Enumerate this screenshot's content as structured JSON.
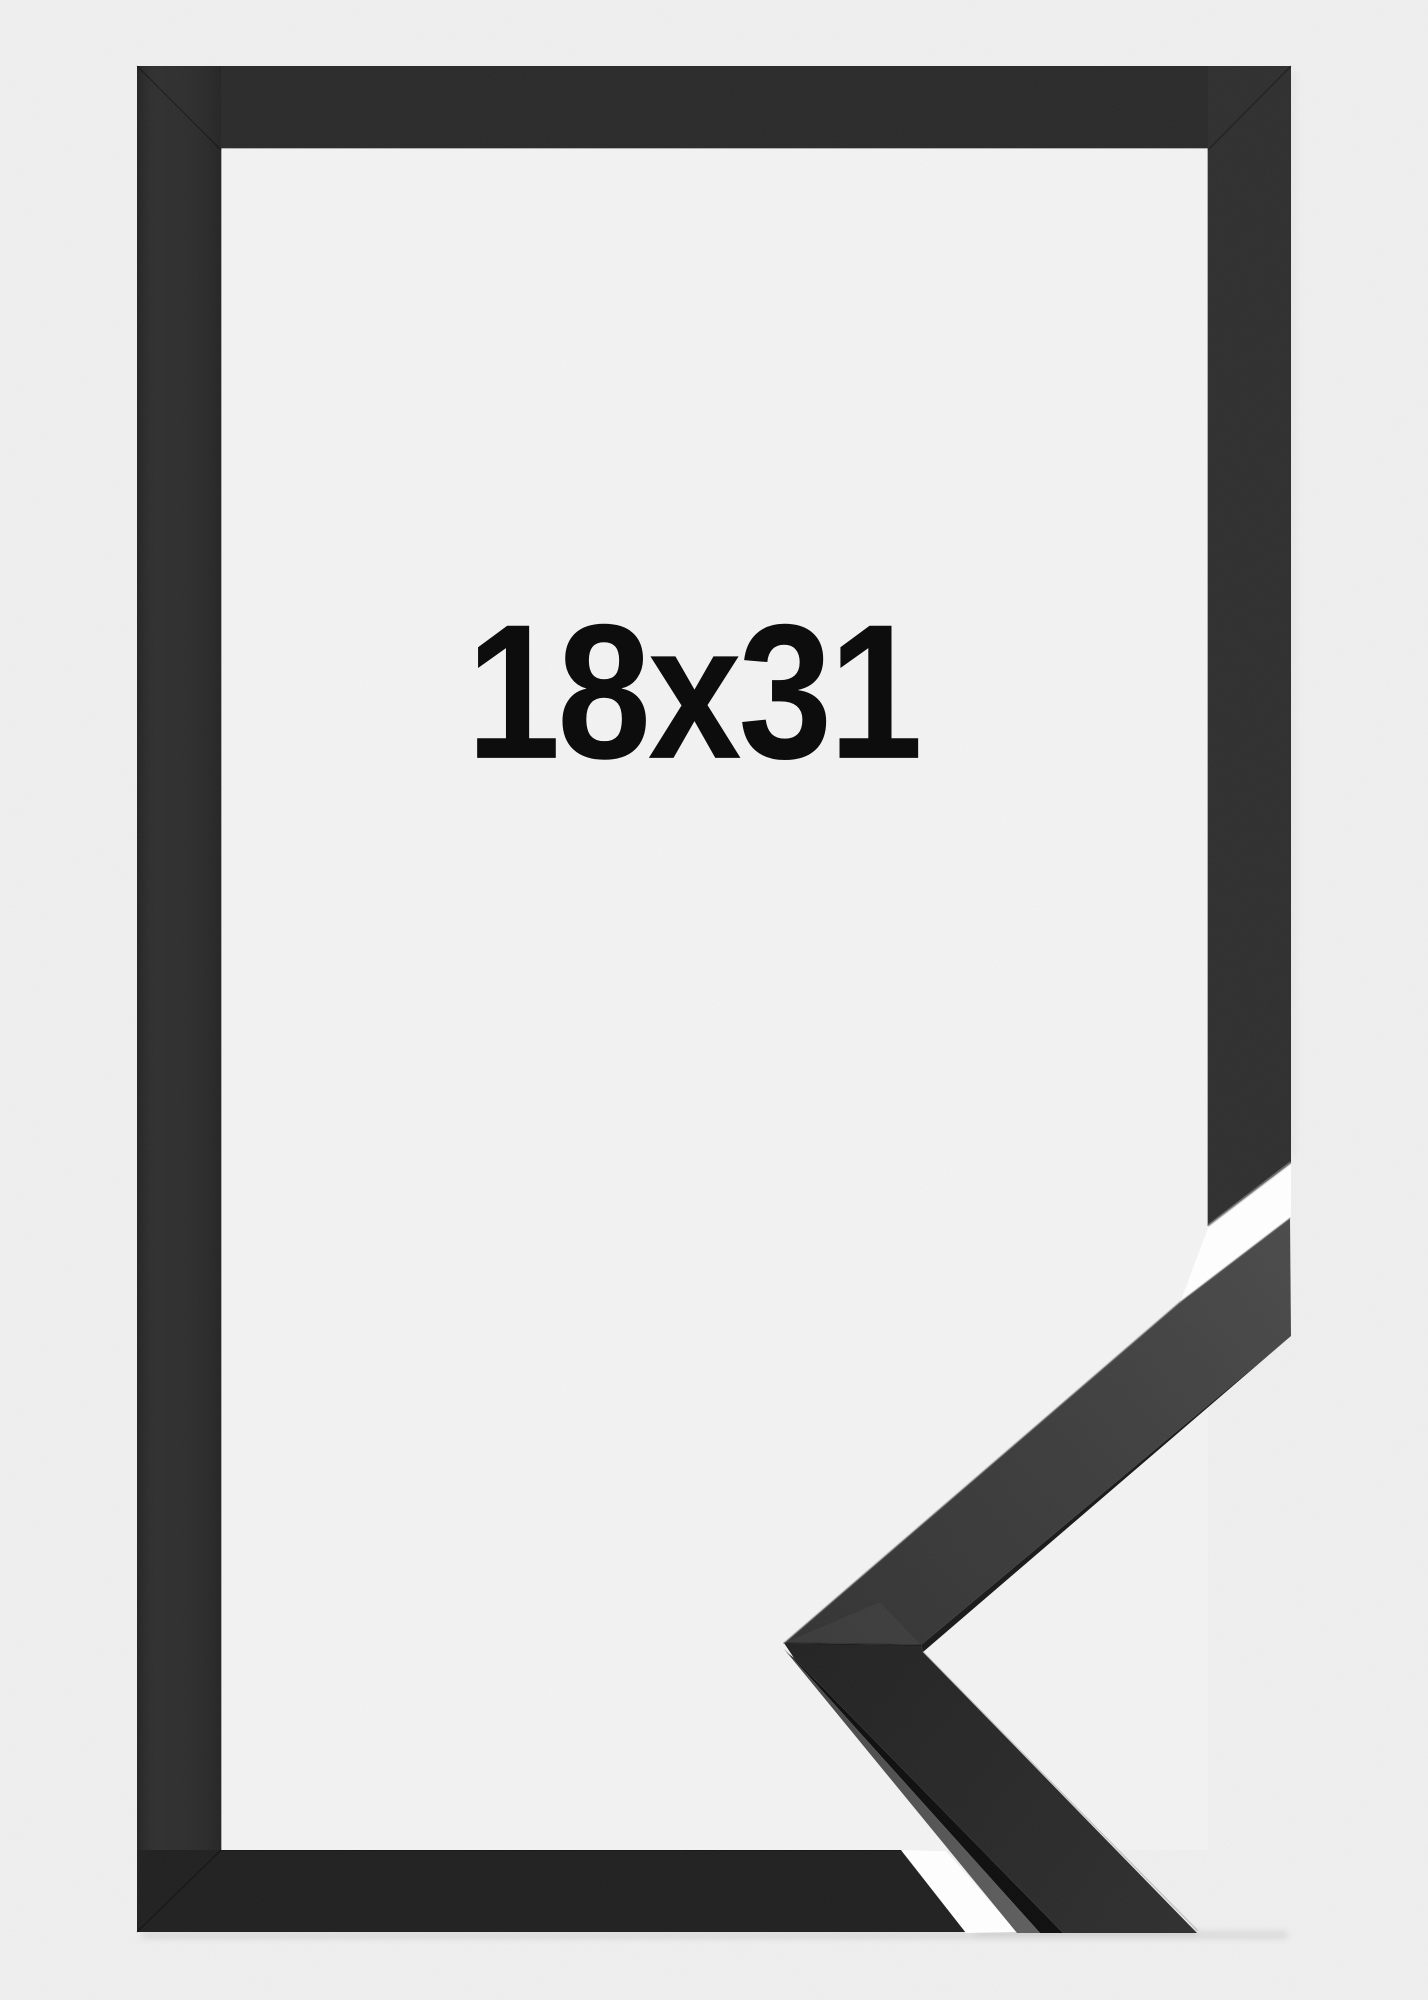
{
  "product": {
    "size_label": "18x31"
  },
  "colors": {
    "background": "#efefef",
    "frame_interior": "#f3f3f4",
    "frame_black": "#282828",
    "corner_piece_face": "#3e3e3e",
    "corner_piece_side_light": "#5a5a5a",
    "cut_gap": "#ffffff",
    "label_text": "#0d0d0d"
  }
}
